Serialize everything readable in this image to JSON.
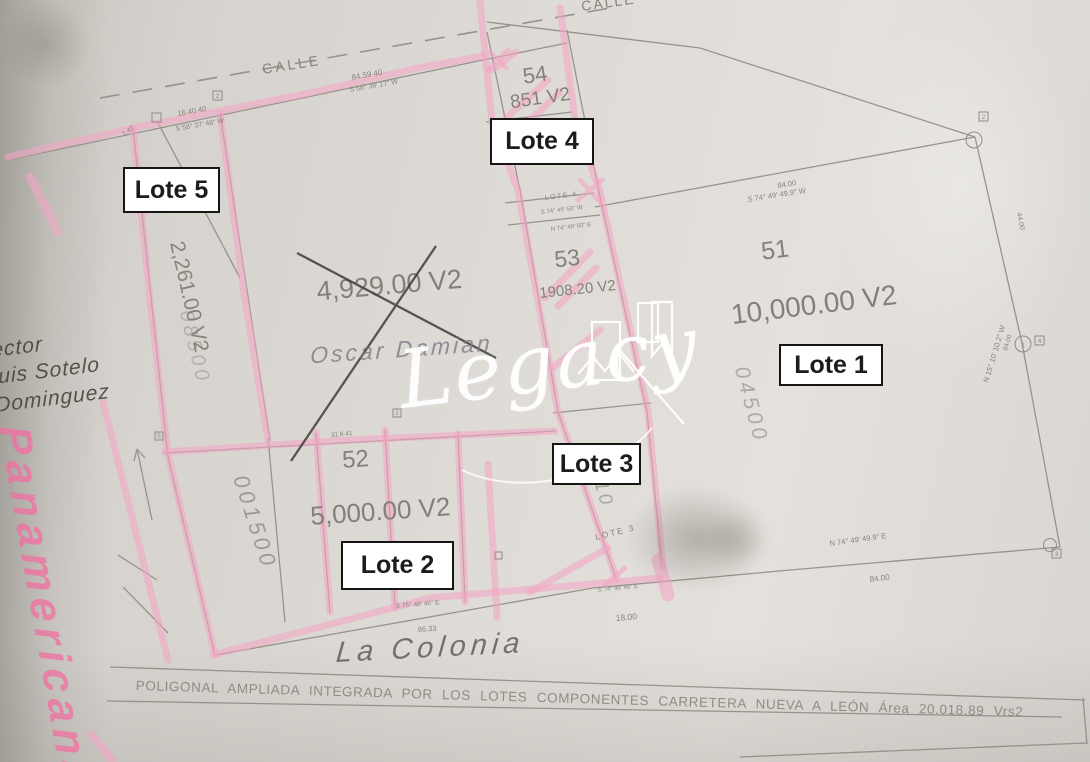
{
  "watermark": {
    "text": "Legacy"
  },
  "labels": {
    "lote1": "Lote 1",
    "lote2": "Lote 2",
    "lote3": "Lote 3",
    "lote4": "Lote 4",
    "lote5": "Lote 5"
  },
  "streets": {
    "top_left": "CALLE",
    "top_right": "CALLE"
  },
  "lots": {
    "lot54": {
      "number": "54",
      "area": "851 V2"
    },
    "lot53": {
      "number": "53",
      "area": "1908.20 V2"
    },
    "lot51": {
      "number": "51",
      "area": "10,000.00 V2"
    },
    "lot52": {
      "number": "52",
      "area": "5,000.00 V2"
    },
    "center": {
      "area": "4,929.00 V2"
    },
    "west_strip": {
      "area": "2,261.00 V2"
    }
  },
  "dims": {
    "d1": "84.59 40",
    "b1": "S 58° 39' 17\" W",
    "d2": "16.40 40",
    "b2": "S 58° 37' 48\" W",
    "d3": "1.47",
    "d4": "84.00",
    "b4": "S 74° 49' 49.9\" W",
    "d5": "44.00",
    "d6": "84.00",
    "b6": "N 15° 10' 10.2\" W",
    "d7": "84.00",
    "b7": "N 74° 49' 49.9\" E",
    "d8": "18.00",
    "b8": "S 74° 48' 46\" E",
    "b9": "S 75° 48' 46\" E",
    "d9": "86.33",
    "d10": "31.8 41",
    "lote4_small": "LOTE 4",
    "b10": "S 74° 49' 50\" W",
    "b11": "N 74° 49' 50\" E",
    "lote3_small": "LOTE 3"
  },
  "markers": {
    "m1": "2",
    "m2": "2",
    "m3": "1",
    "m4": "4",
    "m5": "3",
    "m6": "2",
    "m7": "5"
  },
  "handwriting": {
    "crossed_name": "Oscar Damian",
    "owner_line1": "ector",
    "owner_line2": "uis Sotelo",
    "owner_line3": "Dominguez",
    "colonia": "La Colonia",
    "highway": "Panamericana",
    "pencil_51": "04500",
    "pencil_52": "001500",
    "pencil_strip": "2,910",
    "pencil_west": "08500"
  },
  "footer": {
    "caption": "POLIGONAL AMPLIADA INTEGRADA POR LOS LOTES COMPONENTES CARRETERA NUEVA A LEÓN Área 20,018.89 Vrs2"
  },
  "colors": {
    "highlighter": "#f3a5c4",
    "ink": "#8a8780",
    "pencil": "#6e6a64",
    "label_border": "#151515",
    "watermark": "#ffffff"
  }
}
